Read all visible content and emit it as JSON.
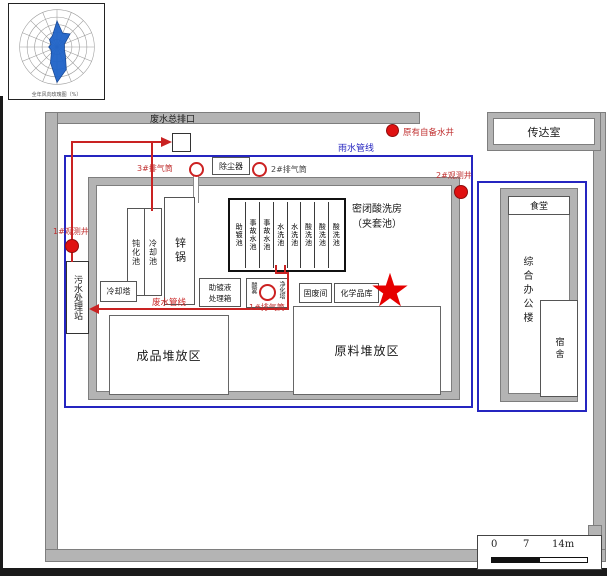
{
  "windrose": {
    "caption": "全年风向玫瑰图（%）"
  },
  "site": {
    "waste_outlet": "废水总排口",
    "existing_well": "原有自备水井",
    "gatehouse": "传达室",
    "rain_pipeline": "雨水管线",
    "waste_pipeline": "废水管线",
    "observation_well_1": "1#观测井",
    "observation_well_2": "2#观测井",
    "sewage_station": "污水处理站",
    "stack_1": "1#排气筒",
    "stack_2": "2#排气筒",
    "stack_3": "3#排气筒",
    "dust_collector": "除尘器"
  },
  "workshop": {
    "passivation_pool": "钝化池",
    "cooling_pool": "冷却池",
    "zinc_kettle": "锌锅",
    "acid_house_title": "密闭酸洗房",
    "acid_house_subtitle": "（夹套池）",
    "acid_cells": [
      "助镀池",
      "事故水池",
      "事故水池",
      "水洗池",
      "水洗池",
      "酸洗池",
      "酸洗池",
      "酸洗池"
    ],
    "cooling_tower": "冷却塔",
    "flux_box": [
      "助镀液",
      "处理箱"
    ],
    "mist_tower_left": "酸雾",
    "mist_tower_right": "净化塔",
    "solid_waste_room": "固废间",
    "chemical_store": "化学品库",
    "finished_area": "成品堆放区",
    "raw_area": "原料堆放区"
  },
  "office": {
    "canteen": "食堂",
    "office_building": "综合办公楼",
    "dormitory": "宿舍"
  },
  "scalebar": {
    "zero": "0",
    "mid": "7",
    "end": "14m"
  },
  "glyphs": {
    "star": "★"
  }
}
